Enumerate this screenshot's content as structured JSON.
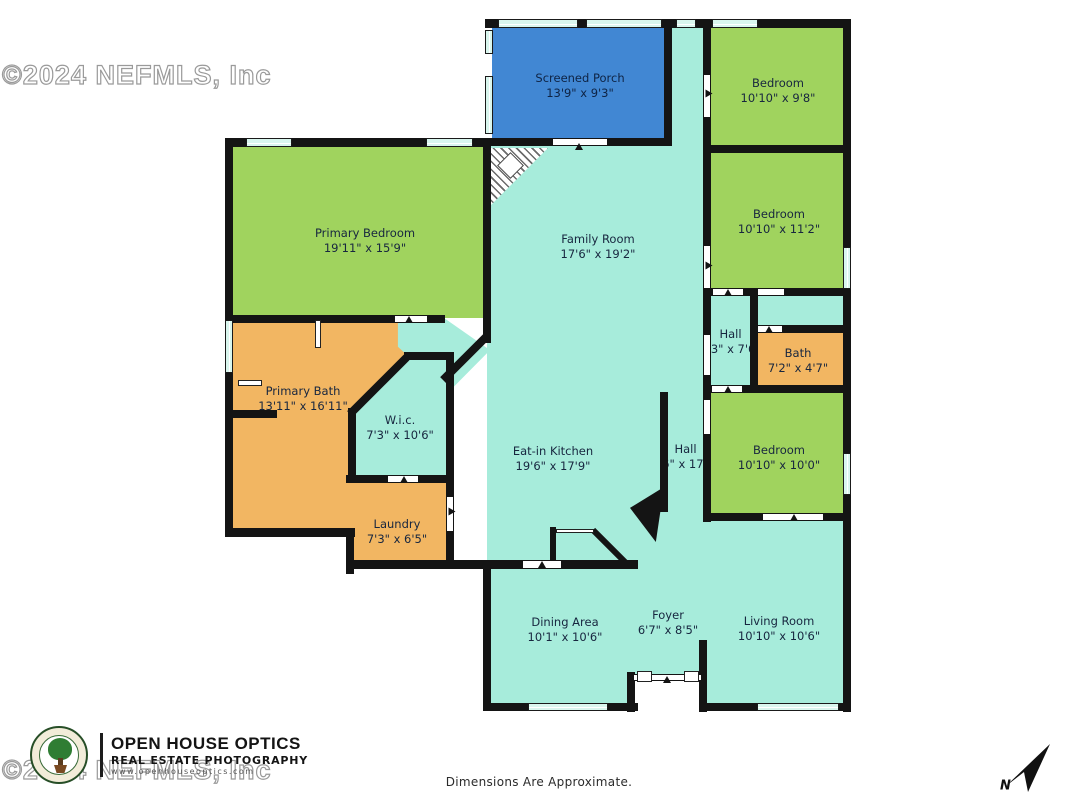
{
  "plan": {
    "rooms": [
      {
        "id": "screened-porch",
        "name": "Screened Porch",
        "dims": "13'9\" x 9'3\""
      },
      {
        "id": "bedroom-top",
        "name": "Bedroom",
        "dims": "10'10\" x 9'8\""
      },
      {
        "id": "bedroom-middle",
        "name": "Bedroom",
        "dims": "10'10\" x 11'2\""
      },
      {
        "id": "hall-right",
        "name": "Hall",
        "dims": "3'3\" x 7'6\""
      },
      {
        "id": "bath",
        "name": "Bath",
        "dims": "7'2\" x 4'7\""
      },
      {
        "id": "bedroom-lower",
        "name": "Bedroom",
        "dims": "10'10\" x 10'0\""
      },
      {
        "id": "living-room",
        "name": "Living Room",
        "dims": "10'10\" x 10'6\""
      },
      {
        "id": "family-room",
        "name": "Family Room",
        "dims": "17'6\" x 19'2\""
      },
      {
        "id": "eat-in-kitchen",
        "name": "Eat-in Kitchen",
        "dims": "19'6\" x 17'9\""
      },
      {
        "id": "hall-center",
        "name": "Hall",
        "dims": "3'6\" x 17'9\""
      },
      {
        "id": "primary-bedroom",
        "name": "Primary Bedroom",
        "dims": "19'11\" x 15'9\""
      },
      {
        "id": "primary-bath",
        "name": "Primary Bath",
        "dims": "13'11\" x 16'11\""
      },
      {
        "id": "wic",
        "name": "W.i.c.",
        "dims": "7'3\" x 10'6\""
      },
      {
        "id": "laundry",
        "name": "Laundry",
        "dims": "7'3\" x 6'5\""
      },
      {
        "id": "dining-area",
        "name": "Dining Area",
        "dims": "10'1\" x 10'6\""
      },
      {
        "id": "foyer",
        "name": "Foyer",
        "dims": "6'7\" x 8'5\""
      }
    ],
    "footer_note": "Dimensions Are Approximate.",
    "watermark": "©2024 NEFMLS, Inc",
    "logo": {
      "line1": "OPEN HOUSE OPTICS",
      "line2": "REAL ESTATE PHOTOGRAPHY",
      "line3": "www.openhouseoptics.com"
    },
    "north_label": "N",
    "colors": {
      "room_teal": "#a7ecdb",
      "room_green": "#a0d35e",
      "porch_blue": "#4187d3",
      "room_orange": "#f2b662",
      "wall_black": "#141414",
      "label_navy": "#17263f"
    }
  }
}
